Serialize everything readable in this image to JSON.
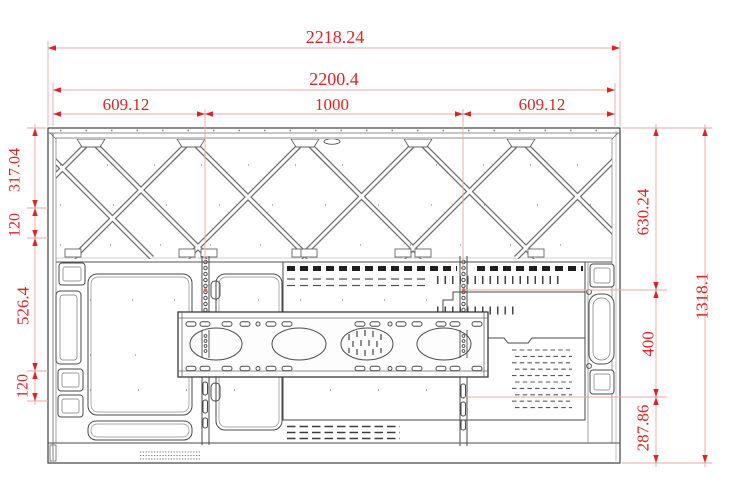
{
  "drawing": {
    "colors": {
      "dimension_red": "#d92525",
      "extension_pink": "#eda4a4",
      "line_gray": "#3f3f3f",
      "background": "#ffffff"
    },
    "dims": {
      "total_width": "2218.24",
      "body_width": "2200.4",
      "left_offset": "609.12",
      "center_span": "1000",
      "right_offset": "609.12",
      "left_top": "317.04",
      "left_gap_upper": "120",
      "left_mid": "526.4",
      "left_gap_lower": "120",
      "right_top": "630.24",
      "vesa_vertical": "400",
      "right_bottom": "287.86",
      "total_height": "1318.1"
    }
  }
}
